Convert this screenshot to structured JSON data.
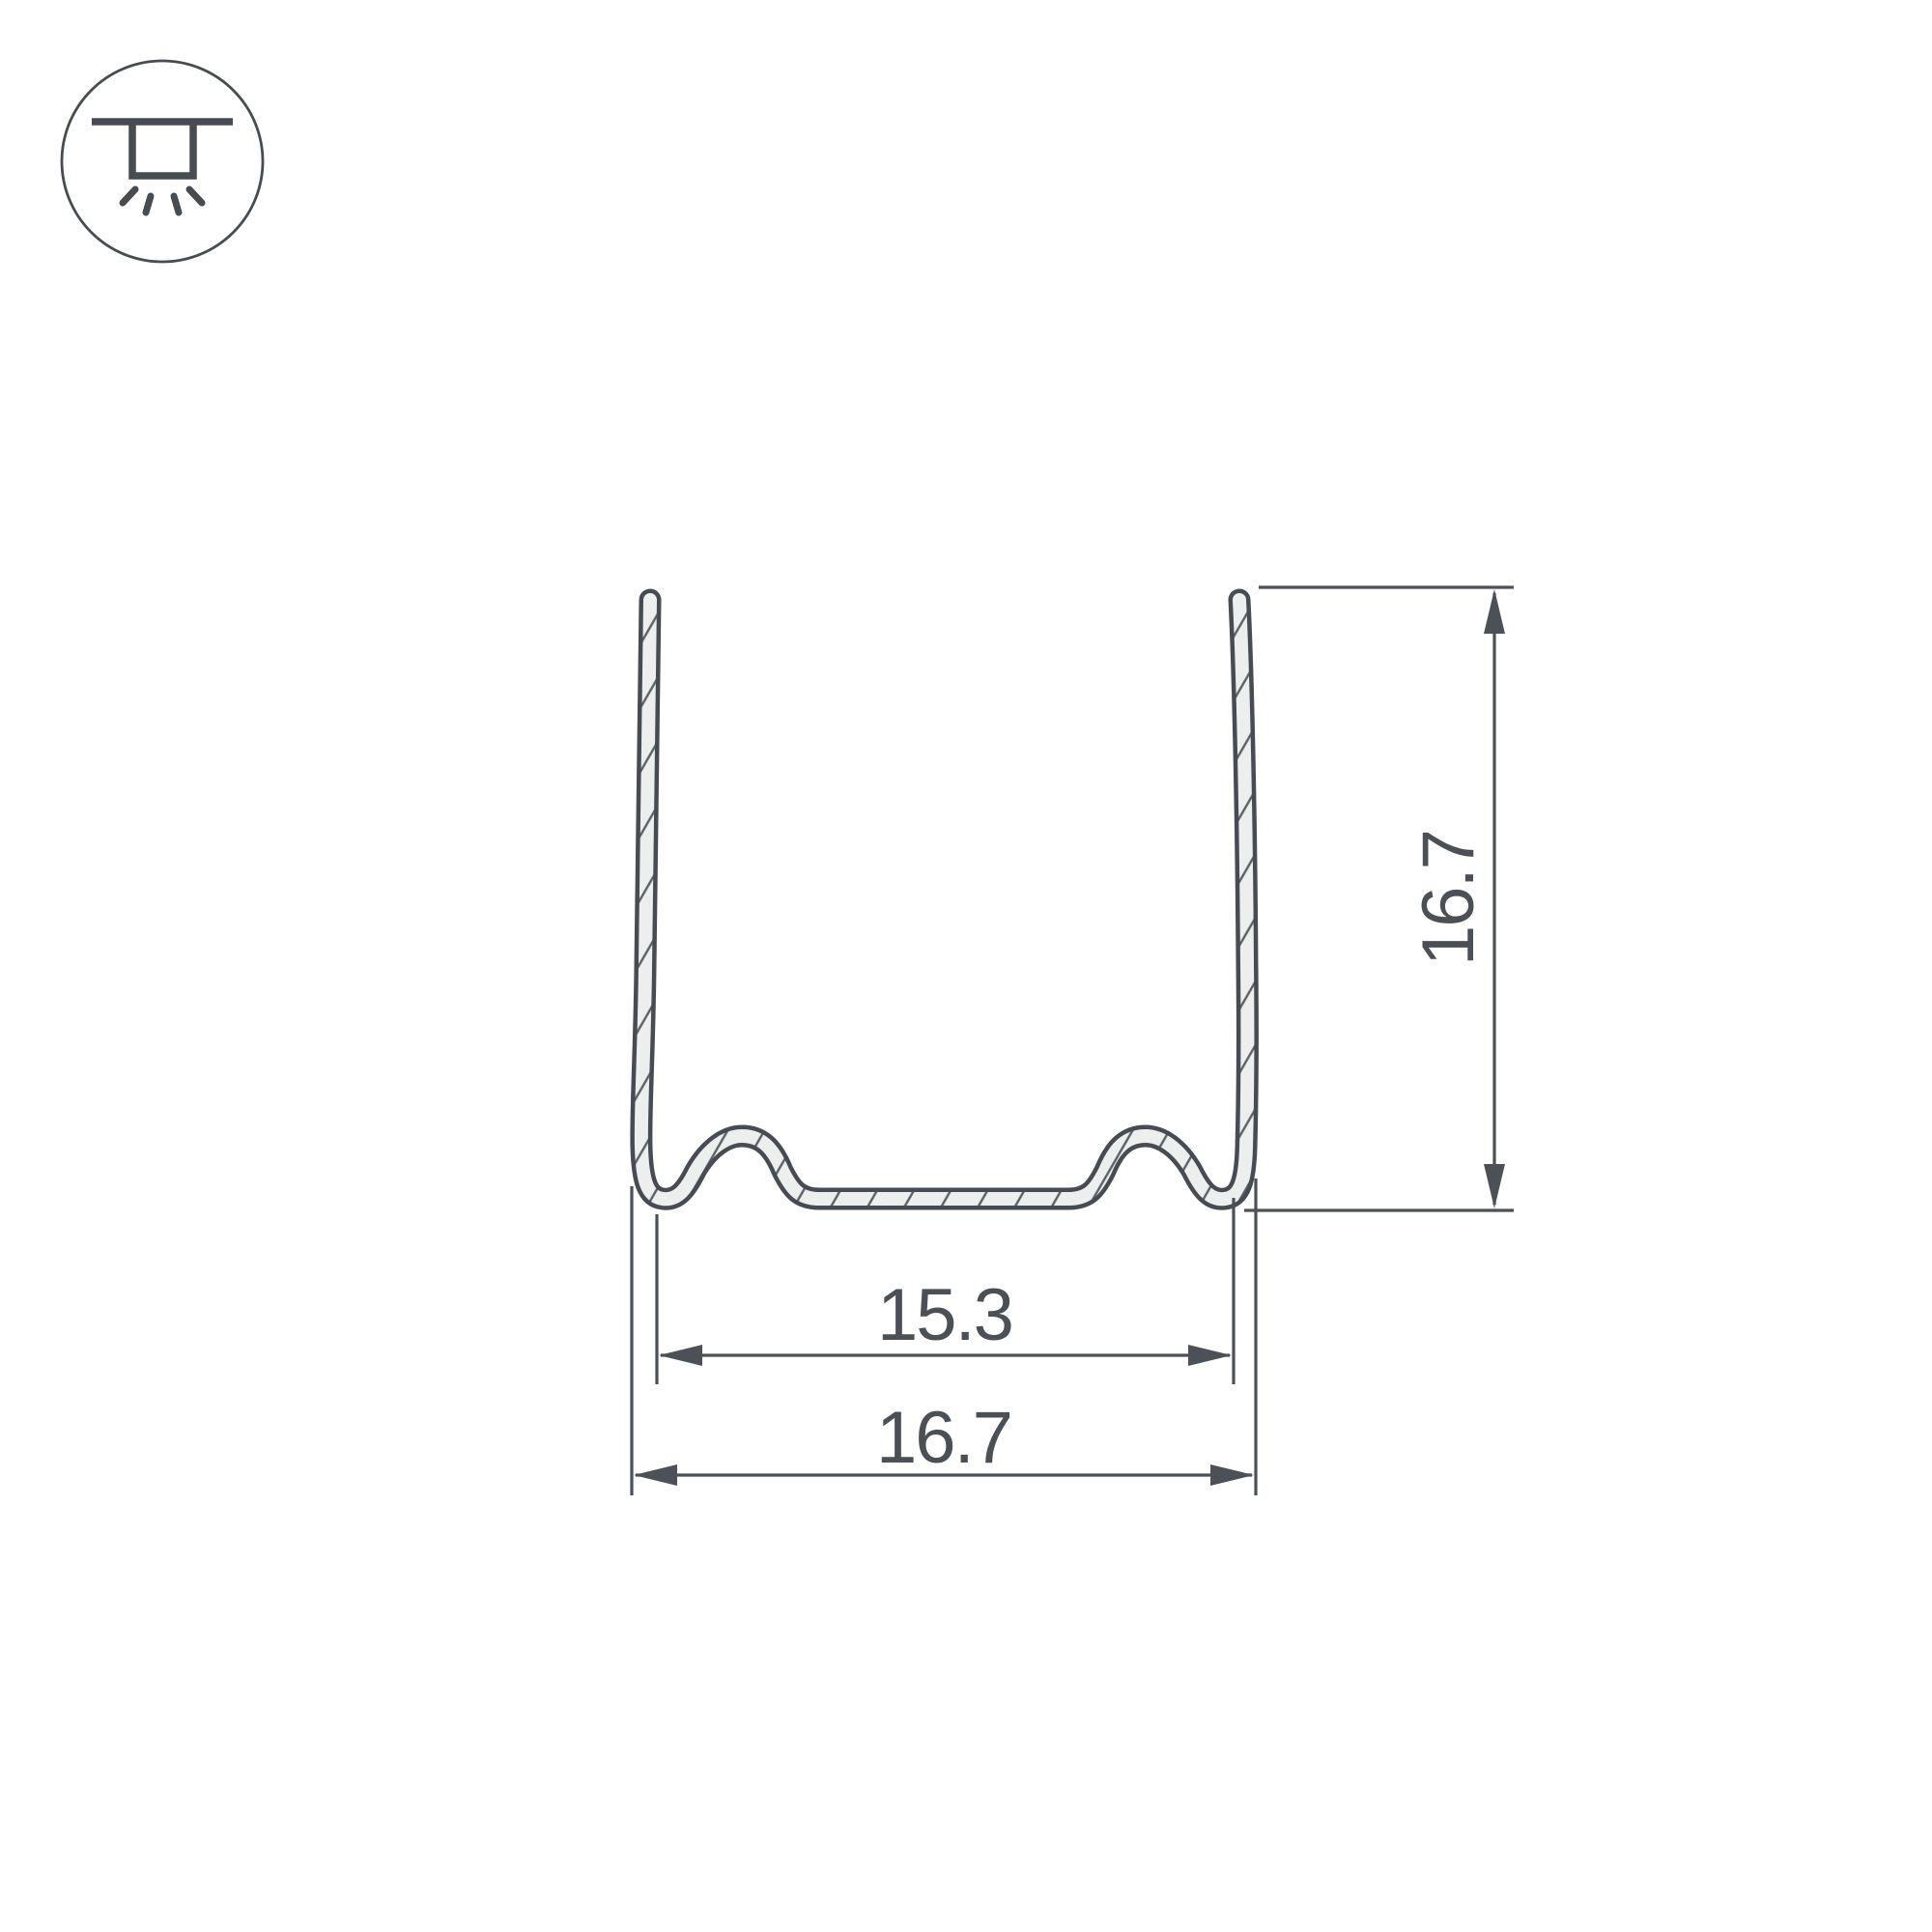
{
  "colors": {
    "background": "#ffffff",
    "line": "#4b5156",
    "outline": "#474c52",
    "text": "#4a5055",
    "sheet_fill": "#edefef",
    "hatch_line": "#5a6065"
  },
  "icons": {
    "mount_type": "recessed-ceiling-light-icon"
  },
  "drawing": {
    "kind": "profile-cross-section"
  },
  "dimensions": {
    "inner_width": {
      "label": "15.3"
    },
    "outer_width": {
      "label": "16.7"
    },
    "height": {
      "label": "16.7"
    }
  }
}
